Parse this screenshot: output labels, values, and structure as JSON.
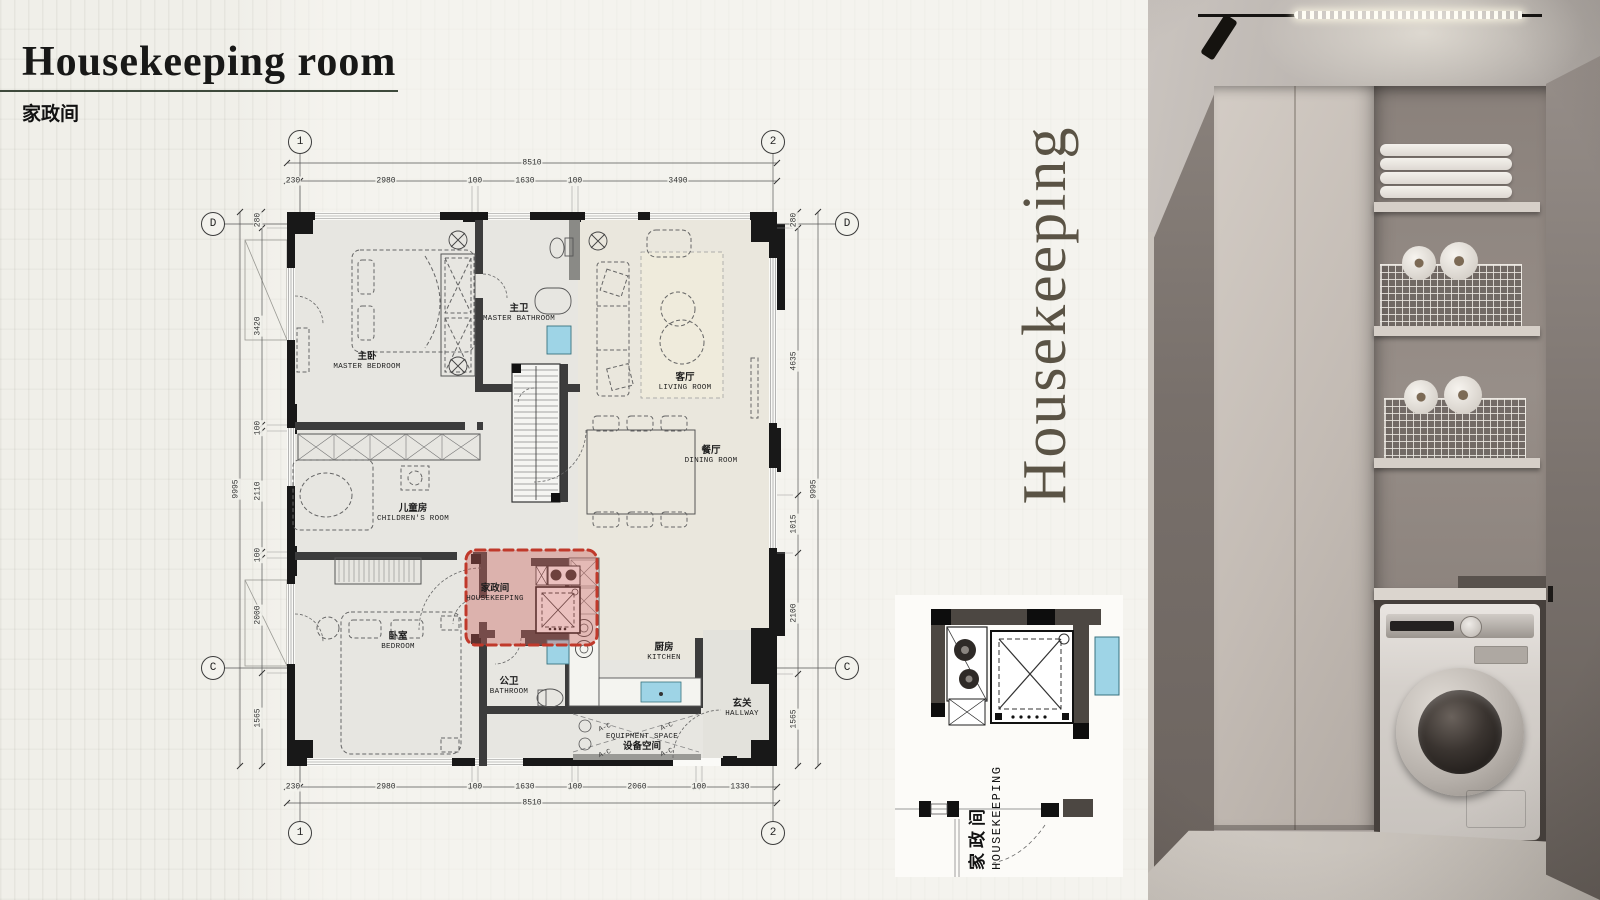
{
  "slide": {
    "title": "Housekeeping room",
    "subtitle_zh": "家政间",
    "side_label": "Housekeeping"
  },
  "plan": {
    "bubbles": {
      "one": "1",
      "two": "2",
      "d": "D",
      "c": "C"
    },
    "dims": {
      "top_total": "8510",
      "top_segments": [
        "230",
        "2980",
        "100",
        "1630",
        "100",
        "3490"
      ],
      "bottom_total": "8510",
      "bottom_segments": [
        "230",
        "2980",
        "100",
        "1630",
        "100",
        "2060",
        "100",
        "1330"
      ],
      "left_total": "9995",
      "left_segments": [
        "280",
        "3420",
        "100",
        "2110",
        "100",
        "2000",
        "1565"
      ],
      "right_total": "9995",
      "right_segments": [
        "280",
        "4635",
        "1015",
        "2100",
        "1565"
      ]
    },
    "rooms": {
      "master_bedroom": {
        "zh": "主卧",
        "en": "MASTER BEDROOM"
      },
      "master_bathroom": {
        "zh": "主卫",
        "en": "MASTER BATHROOM"
      },
      "living_room": {
        "zh": "客厅",
        "en": "LIVING ROOM"
      },
      "dining_room": {
        "zh": "餐厅",
        "en": "DINING ROOM"
      },
      "children_room": {
        "zh": "儿童房",
        "en": "CHILDREN'S ROOM"
      },
      "housekeeping": {
        "zh": "家政间",
        "en": "HOUSEKEEPING"
      },
      "bedroom": {
        "zh": "卧室",
        "en": "BEDROOM"
      },
      "bathroom": {
        "zh": "公卫",
        "en": "BATHROOM"
      },
      "kitchen": {
        "zh": "厨房",
        "en": "KITCHEN"
      },
      "hallway": {
        "zh": "玄关",
        "en": "HALLWAY"
      },
      "equipment": {
        "zh": "设备空间",
        "en": "EQUIPMENT SPACE"
      }
    },
    "ac_mark": "A-C"
  },
  "detail": {
    "zh": "家政间",
    "en": "HOUSEKEEPING"
  },
  "colors": {
    "highlight_border": "#c0392b",
    "highlight_fill": "rgba(205,100,95,0.40)",
    "side_text": "#5a5345",
    "underline": "#3e4a3c",
    "water_fixture": "#9ed4e6"
  }
}
